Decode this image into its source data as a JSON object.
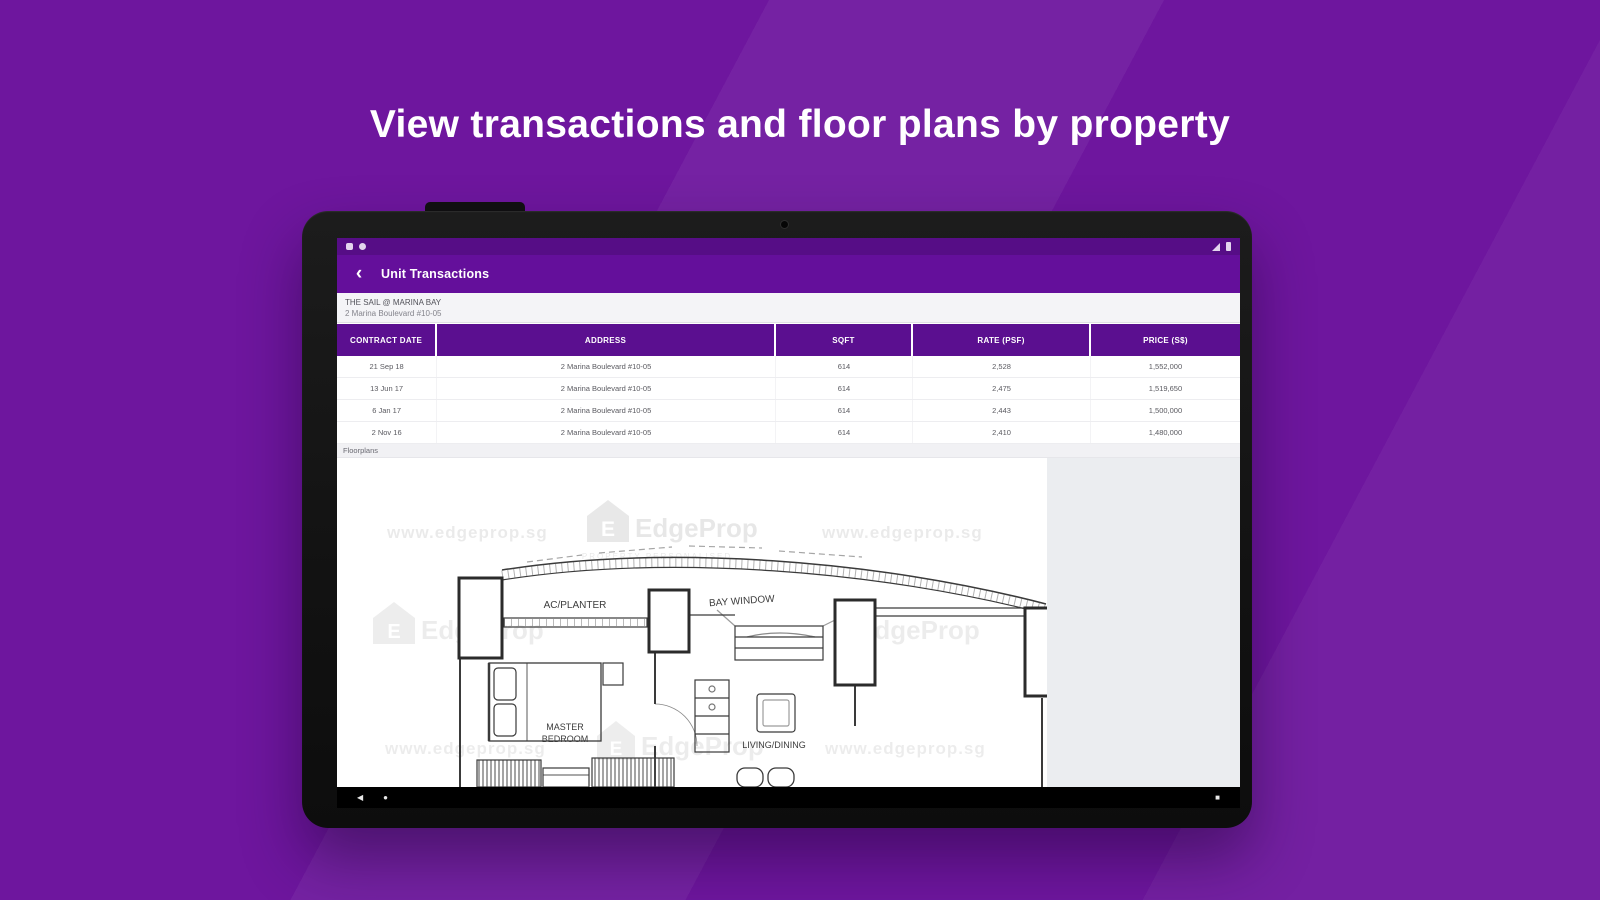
{
  "hero": {
    "headline": "View transactions and floor plans by property"
  },
  "colors": {
    "background": "#6e169e",
    "statusbar": "#560d86",
    "appbar": "#640f9b",
    "table_header": "#5b0f90",
    "bezel": "#141414",
    "floor_gray": "#ebedf0"
  },
  "app": {
    "statusbar": {
      "left_icons": [
        "notification-icon",
        "sync-icon"
      ],
      "right_icons": [
        "signal-icon",
        "battery-icon"
      ]
    },
    "appbar": {
      "back_glyph": "‹",
      "title": "Unit Transactions"
    },
    "property": {
      "name": "THE SAIL @ MARINA BAY",
      "address": "2 Marina Boulevard #10-05"
    },
    "table": {
      "columns": [
        "CONTRACT DATE",
        "ADDRESS",
        "SQFT",
        "RATE (PSF)",
        "PRICE (S$)"
      ],
      "rows": [
        [
          "21 Sep 18",
          "2 Marina Boulevard #10-05",
          "614",
          "2,528",
          "1,552,000"
        ],
        [
          "13 Jun 17",
          "2 Marina Boulevard #10-05",
          "614",
          "2,475",
          "1,519,650"
        ],
        [
          "6 Jan 17",
          "2 Marina Boulevard #10-05",
          "614",
          "2,443",
          "1,500,000"
        ],
        [
          "2 Nov 16",
          "2 Marina Boulevard #10-05",
          "614",
          "2,410",
          "1,480,000"
        ]
      ]
    },
    "section_label": "Floorplans",
    "floorplan": {
      "labels": {
        "ac_planter": "AC/PLANTER",
        "bay_window": "BAY WINDOW",
        "master_bedroom_line1": "MASTER",
        "master_bedroom_line2": "BEDROOM",
        "living_dining": "LIVING/DINING"
      },
      "watermark": {
        "url": "www.edgeprop.sg",
        "brand": "EdgeProp",
        "brand_initial": "E",
        "tagline": "PROPERTY PERSONALISED"
      }
    },
    "navbar": {
      "back_glyph": "◀",
      "home_glyph": "●",
      "recents_glyph": "■"
    }
  }
}
